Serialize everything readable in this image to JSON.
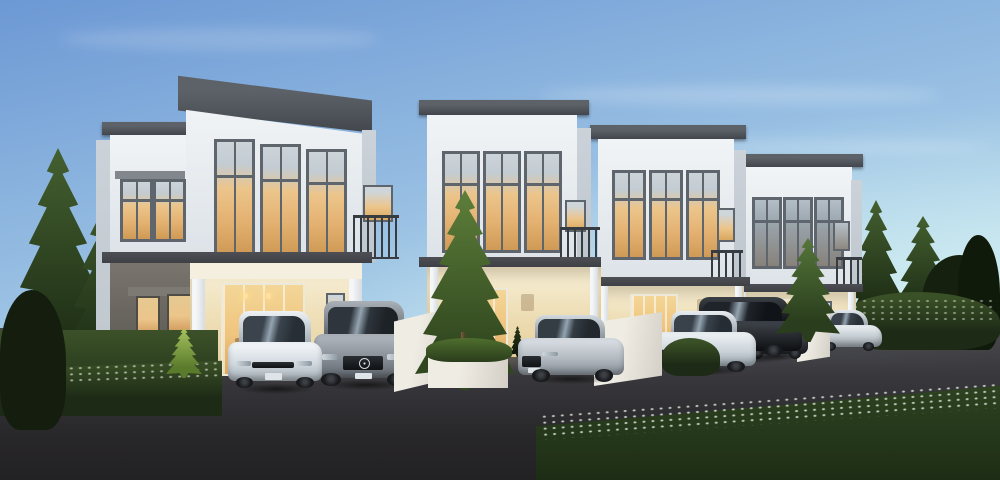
{
  "scene": {
    "label": "Dusk architectural rendering of a row of modern two-storey townhouses with parked cars",
    "time_of_day": "dusk",
    "houses": [
      {
        "id": "unit-1",
        "label": "Townhouse unit 1 (nearest): white facade, slanted dark cornice, three tall lit windows, side balcony, grey lower end wall, lit porch with glass sliding door"
      },
      {
        "id": "unit-2",
        "label": "Townhouse unit 2: white tower, three tall lit windows, side balcony, lit porch with glass door and yard tree"
      },
      {
        "id": "unit-3",
        "label": "Townhouse unit 3: white tower, three tall lit windows, side balcony, lit porch"
      },
      {
        "id": "unit-4",
        "label": "Townhouse unit 4 (farthest): white tower, three dim windows, side balcony, lit porch"
      }
    ],
    "vehicles": [
      {
        "id": "car-1",
        "type": "hatchback",
        "color": "white",
        "label": "white hatchback parked in driveway 1"
      },
      {
        "id": "car-2",
        "type": "suv",
        "color": "grey",
        "label": "grey luxury SUV with three-pointed-star grille emblem"
      },
      {
        "id": "car-3",
        "type": "sedan",
        "color": "silver",
        "label": "silver sedan parked in driveway 2"
      },
      {
        "id": "car-4",
        "type": "sedan",
        "color": "white",
        "label": "white sedan parked in driveway 3"
      },
      {
        "id": "car-5",
        "type": "suv",
        "color": "black",
        "label": "black SUV parked behind white sedan"
      },
      {
        "id": "car-6",
        "type": "hatchback",
        "color": "dark-grey",
        "label": "dark grey hatchback in driveway 4"
      },
      {
        "id": "car-7",
        "type": "sedan",
        "color": "white",
        "label": "white sedan at far right driveway"
      }
    ],
    "vegetation": {
      "left": "tall conifer trees and flowering hedge",
      "right": "conifer trees, dark tree mass and flowering hedge",
      "yard": "spot-lit ornamental trees and shrubs in white planters",
      "foreground": "grass verge with band of small white flowers"
    },
    "road": "dark asphalt street in front of the driveways"
  },
  "palette": {
    "sky_top": "#6c98d4",
    "sky_mid": "#9cc3e4",
    "sky_horizon": "#cdeaf0",
    "cloud": "#ffffff",
    "wall_light": "#f1f4f6",
    "wall_shade": "#dde3e8",
    "wall_side": "#cbd2d9",
    "cornice_top": "#5d6269",
    "cornice_bottom": "#42464c",
    "frame_gray": "#5f656c",
    "glass_amber": "#ecc58b",
    "glass_amber_deep": "#cf9a55",
    "glass_dim_top": "#b3bec6",
    "glass_dim_bottom": "#87817a",
    "band_dark": "#4d4f54",
    "porch_hi": "#f7f0d9",
    "porch_lo": "#e7cf9a",
    "door_amber": "#f3d697",
    "door_amber_deep": "#daa961",
    "end_wall_hi": "#79756e",
    "end_wall_lo": "#57544e",
    "fence_hi": "#efece4",
    "fence_lo": "#d3cfc7",
    "rail_dark": "#373c42",
    "road_hi": "#47464a",
    "road_lo": "#222124",
    "grass_hi": "#3c5129",
    "grass_lo": "#24351a",
    "hedge_dark": "#1d2a16",
    "hedge_hi": "#3a5026",
    "pine_hi": "#446030",
    "pine_lo": "#1c2b14",
    "pine_dark": "#121c0c",
    "foliage_lit": "#8fae52",
    "flower_dot": "#e7efe4",
    "lamp_glow": "#ffd98f"
  }
}
